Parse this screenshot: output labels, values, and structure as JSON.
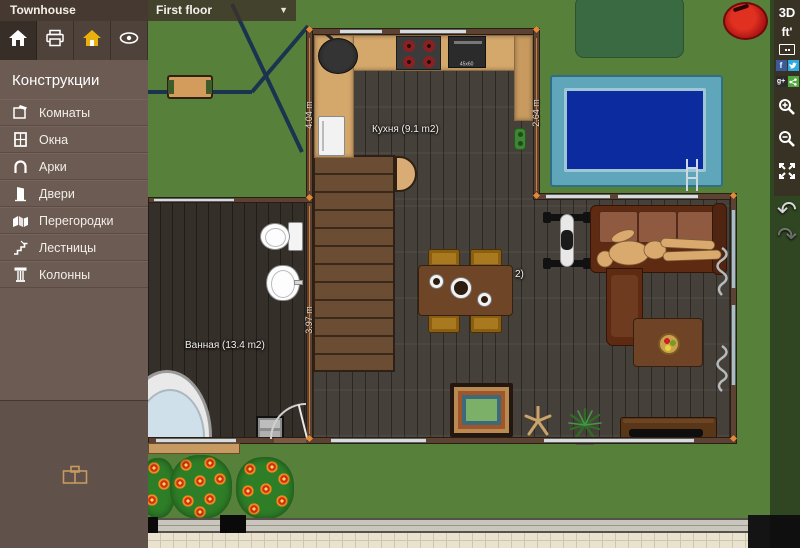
{
  "header": {
    "title": "Townhouse",
    "floor_selector": {
      "value": "First floor",
      "caret": "▼"
    }
  },
  "main_toolbar": {
    "buttons": [
      {
        "icon": "home-icon",
        "active": true
      },
      {
        "icon": "printer-icon",
        "active": false
      },
      {
        "icon": "gold-house-icon",
        "active": false
      },
      {
        "icon": "eye-icon",
        "active": false
      }
    ]
  },
  "sidebar": {
    "header": "Конструкции",
    "items": [
      {
        "label": "Комнаты",
        "icon": "rooms-icon"
      },
      {
        "label": "Окна",
        "icon": "windows-icon"
      },
      {
        "label": "Арки",
        "icon": "arches-icon"
      },
      {
        "label": "Двери",
        "icon": "doors-icon"
      },
      {
        "label": "Перегородки",
        "icon": "partitions-icon"
      },
      {
        "label": "Лестницы",
        "icon": "stairs-icon"
      },
      {
        "label": "Колонны",
        "icon": "columns-icon"
      }
    ],
    "footer_icon": "furniture-icon"
  },
  "right_toolbar": {
    "view_3d": "3D",
    "units": "ft'",
    "facebook": "f",
    "google_plus": "g+",
    "undo_glyph": "↶",
    "redo_glyph": "↷"
  },
  "floorplan": {
    "rooms": [
      {
        "name": "kitchen",
        "label": "Кухня (9.1 m2)"
      },
      {
        "name": "bathroom",
        "label": "Ванная (13.4 m2)"
      },
      {
        "name": "living",
        "label_partial": "2)"
      }
    ],
    "dimensions": [
      {
        "wall": "kitchen-left",
        "value": "4.04 m"
      },
      {
        "wall": "kitchen-right",
        "value": "2.64 m"
      },
      {
        "wall": "bathroom-right",
        "value": "3.97 m"
      }
    ],
    "oven_label": "45x60"
  },
  "colors": {
    "sidebar_bg": "#6c5b52",
    "accent_marker": "#e08a3c",
    "pool_water": "#0b2b9e",
    "facebook_blue": "#3b5a98",
    "twitter_blue": "#2caae1",
    "share_green": "#53a93f"
  }
}
